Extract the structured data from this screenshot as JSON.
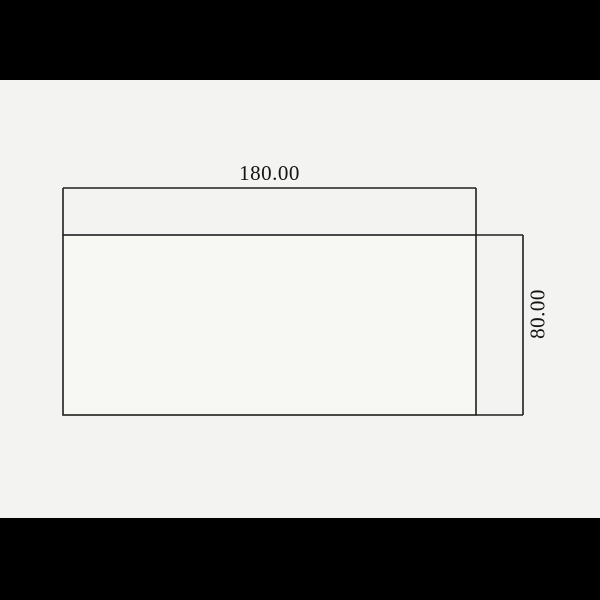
{
  "drawing": {
    "part": {
      "shape": "rectangle"
    },
    "dimensions": {
      "width": {
        "label": "180.00"
      },
      "height": {
        "label": "80.00"
      }
    },
    "colors": {
      "letterbox": "#000000",
      "canvas_background": "#f3f3f1",
      "line": "#1f1f1f",
      "text": "#141414",
      "part_fill": "#f7f7f4"
    }
  }
}
